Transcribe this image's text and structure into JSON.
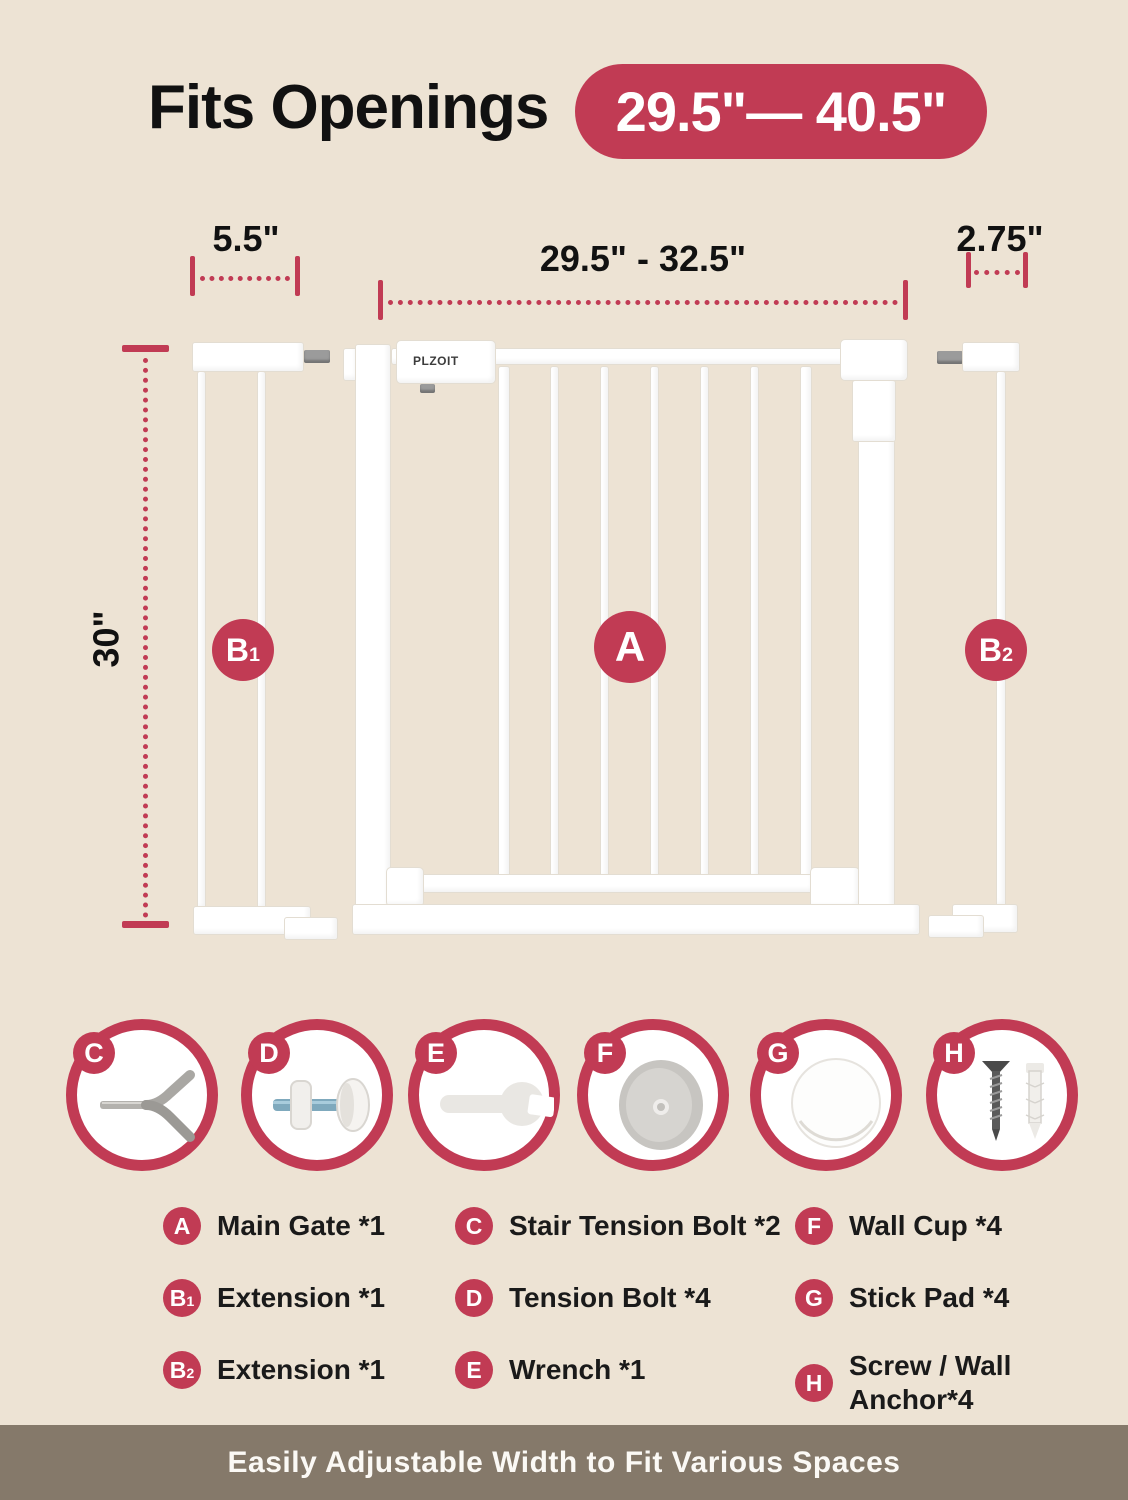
{
  "colors": {
    "background": "#EDE3D4",
    "accent": "#C13B54",
    "banner_background": "#85796A",
    "gate_white": "#FFFFFF"
  },
  "header": {
    "title": "Fits Openings",
    "range_badge": "29.5\"— 40.5\""
  },
  "dimensions": {
    "left_extension_width": "5.5\"",
    "gate_width_range": "29.5\" - 32.5\"",
    "right_extension_width": "2.75\"",
    "gate_height": "30\""
  },
  "diagram": {
    "brand": "PLZOIT",
    "main_gate_label": "A",
    "left_extension_label": {
      "text": "B",
      "sub": "1"
    },
    "right_extension_label": {
      "text": "B",
      "sub": "2"
    }
  },
  "parts_icons": [
    {
      "letter": "C",
      "name": "stair-tension-bolt"
    },
    {
      "letter": "D",
      "name": "tension-bolt"
    },
    {
      "letter": "E",
      "name": "wrench"
    },
    {
      "letter": "F",
      "name": "wall-cup"
    },
    {
      "letter": "G",
      "name": "stick-pad"
    },
    {
      "letter": "H",
      "name": "screw-wall-anchor"
    }
  ],
  "parts_list": {
    "columns": [
      {
        "items": [
          {
            "badge": "A",
            "sub": "",
            "label": "Main Gate *1"
          },
          {
            "badge": "B",
            "sub": "1",
            "label": "Extension *1"
          },
          {
            "badge": "B",
            "sub": "2",
            "label": "Extension *1"
          }
        ]
      },
      {
        "items": [
          {
            "badge": "C",
            "sub": "",
            "label": "Stair Tension Bolt *2"
          },
          {
            "badge": "D",
            "sub": "",
            "label": "Tension Bolt *4"
          },
          {
            "badge": "E",
            "sub": "",
            "label": "Wrench *1"
          }
        ]
      },
      {
        "items": [
          {
            "badge": "F",
            "sub": "",
            "label": "Wall Cup *4"
          },
          {
            "badge": "G",
            "sub": "",
            "label": "Stick Pad *4"
          },
          {
            "badge": "H",
            "sub": "",
            "label": "Screw / Wall\nAnchor*4"
          }
        ]
      }
    ]
  },
  "footer": {
    "banner_text": "Easily Adjustable Width to Fit Various Spaces"
  }
}
